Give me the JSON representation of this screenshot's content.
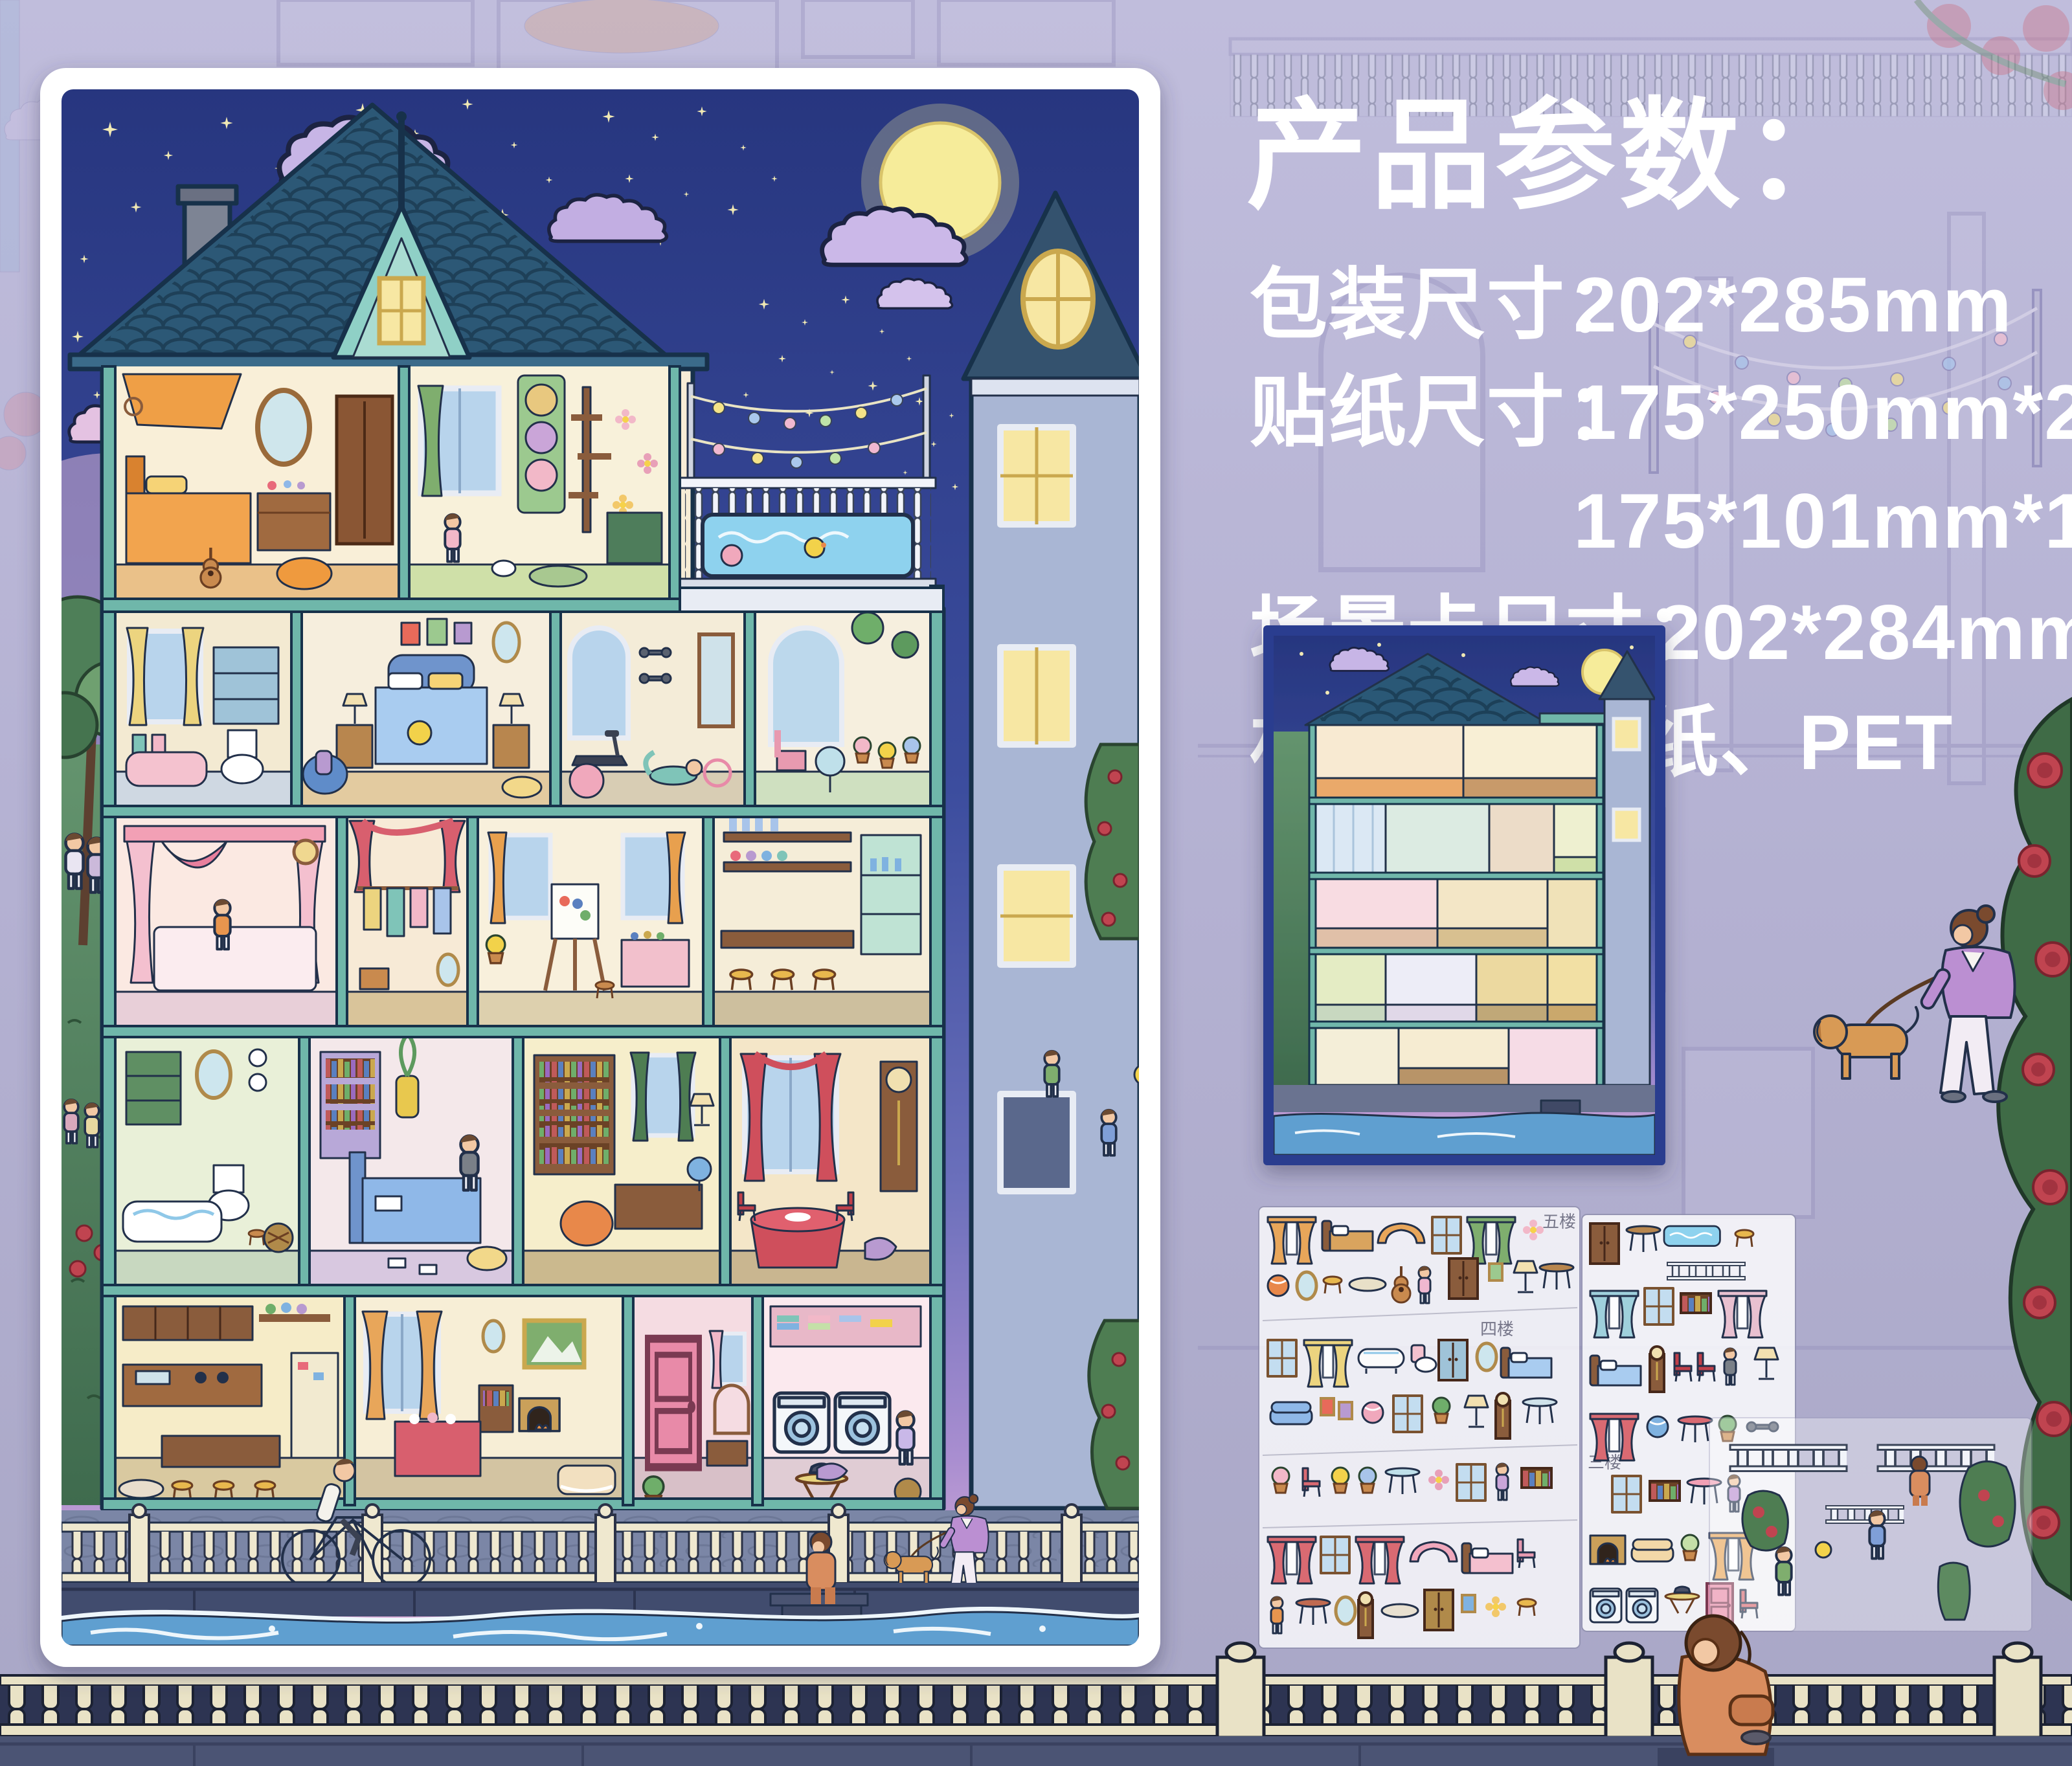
{
  "product_specs": {
    "title": "产品参数：",
    "lines": [
      {
        "label": "包装尺寸：",
        "value": "202*285mm"
      },
      {
        "label": "贴纸尺寸：",
        "value": "175*250mm*2"
      },
      {
        "label": "",
        "value": "175*101mm*1"
      },
      {
        "label": "场景卡尺寸：",
        "value": "202*284mm"
      },
      {
        "label": "材质：",
        "value": "白卡纸、PET"
      }
    ]
  },
  "sticker_sheets": {
    "floor_labels": [
      "五楼",
      "四楼",
      "三楼"
    ],
    "sheet_count": 3,
    "names": [
      "sticker-sheet-paper-1",
      "sticker-sheet-paper-2",
      "sticker-sheet-pet"
    ]
  },
  "scene_card": {
    "name": "scene-card-preview"
  },
  "colors": {
    "canvas_background": "#b7b4d4",
    "poster_frame": "#ffffff",
    "night_sky": "#2c3c92",
    "moon": "#f6ec9a",
    "house_trim": "#6fb7aa",
    "roof": "#2c5876",
    "river": "#5f9fd0",
    "fence": "#e9e2c6",
    "spec_text": "#ffffff",
    "scene_card_border": "#2b3d8f"
  },
  "scene_elements": [
    "moon-icon",
    "stars-icon",
    "cloud-icon",
    "dollhouse",
    "rooftop-pool",
    "string-lights",
    "neighbor-building",
    "garden-tree",
    "couple",
    "cyclist",
    "dog-walker",
    "dock-sitter",
    "river",
    "promenade-fence",
    "rose-bush",
    "sitting-woman",
    "kids-playing"
  ]
}
